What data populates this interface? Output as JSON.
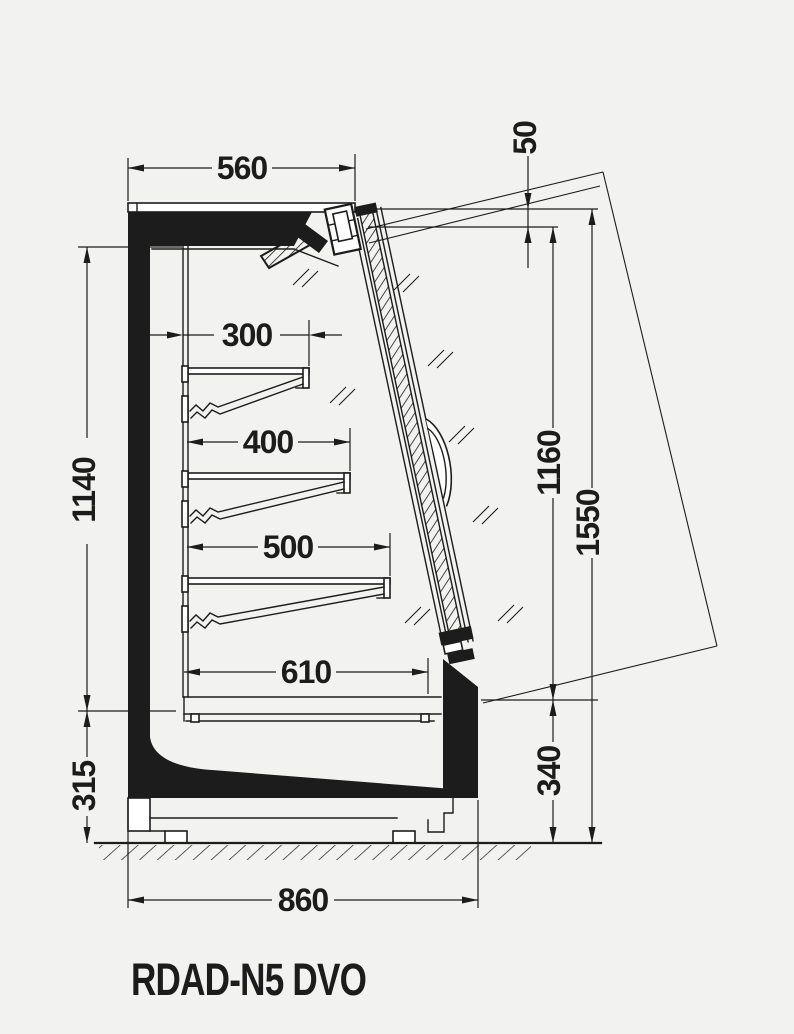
{
  "drawing": {
    "model_label": "RDAD-N5 DVO",
    "dims": {
      "top_depth": "560",
      "lid_offset": "50",
      "shelf_1_depth": "300",
      "shelf_2_depth": "400",
      "shelf_3_depth": "500",
      "base_shelf_depth": "610",
      "interior_height": "1140",
      "base_height_left": "315",
      "glass_door_height": "1160",
      "total_height": "1550",
      "base_height_right": "340",
      "total_depth": "860"
    }
  },
  "colors": {
    "ink": "#1c1c1c",
    "background": "#f2f2f0"
  }
}
